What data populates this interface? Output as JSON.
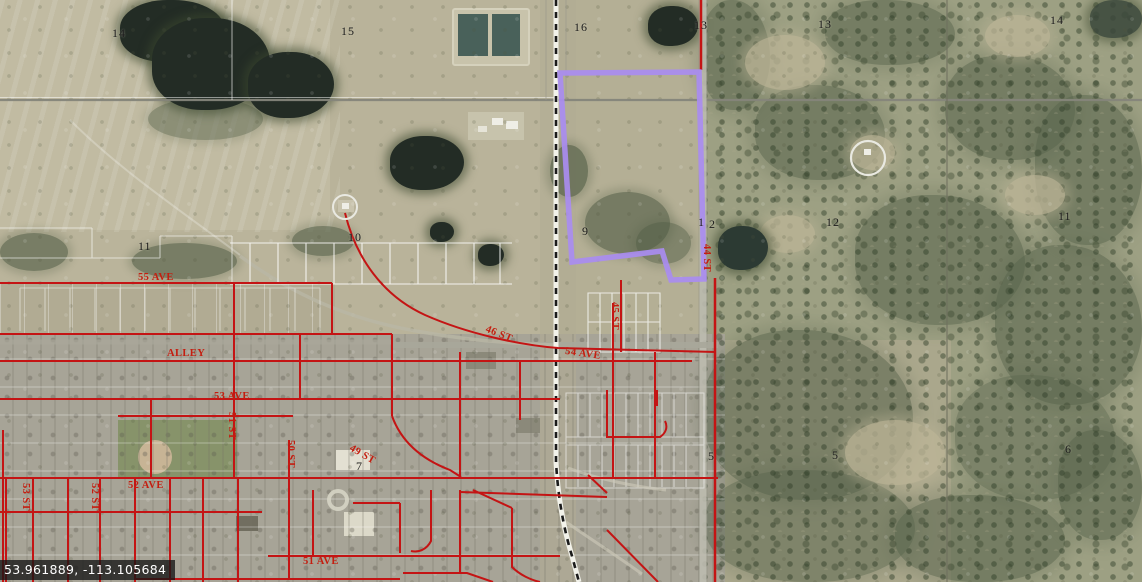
{
  "map_view": {
    "coordinate_readout": "53.961889, -113.105684",
    "colors": {
      "parcel_highlight": "#a98cf0",
      "road_overlay": "#c41414",
      "street_label": "#c41e10",
      "section_label": "#1c1c1c",
      "readout_bg": "rgba(22,22,22,0.78)",
      "readout_text": "#ffffff"
    },
    "section_labels": [
      {
        "text": "14",
        "x": 112,
        "y": 26
      },
      {
        "text": "15",
        "x": 341,
        "y": 24
      },
      {
        "text": "16",
        "x": 574,
        "y": 20
      },
      {
        "text": "13",
        "x": 694,
        "y": 18
      },
      {
        "text": "13",
        "x": 818,
        "y": 17
      },
      {
        "text": "14",
        "x": 1050,
        "y": 13
      },
      {
        "text": "11",
        "x": 138,
        "y": 239
      },
      {
        "text": "10",
        "x": 348,
        "y": 230
      },
      {
        "text": "9",
        "x": 582,
        "y": 224
      },
      {
        "text": "1",
        "x": 698,
        "y": 215
      },
      {
        "text": "2",
        "x": 709,
        "y": 217
      },
      {
        "text": "12",
        "x": 826,
        "y": 215
      },
      {
        "text": "11",
        "x": 1058,
        "y": 209
      },
      {
        "text": "7",
        "x": 356,
        "y": 459
      },
      {
        "text": "5",
        "x": 708,
        "y": 449
      },
      {
        "text": "5",
        "x": 832,
        "y": 448
      },
      {
        "text": "6",
        "x": 1065,
        "y": 442
      }
    ],
    "street_labels": [
      {
        "text": "55 AVE",
        "x": 138,
        "y": 272,
        "rotate": 0
      },
      {
        "text": "ALLEY",
        "x": 167,
        "y": 348,
        "rotate": 0
      },
      {
        "text": "53 AVE",
        "x": 214,
        "y": 391,
        "rotate": 0
      },
      {
        "text": "46 ST",
        "x": 488,
        "y": 324,
        "rotate": 22
      },
      {
        "text": "54 AVE",
        "x": 566,
        "y": 346,
        "rotate": 8
      },
      {
        "text": "45 ST",
        "x": 620,
        "y": 302,
        "rotate": 90
      },
      {
        "text": "44 ST",
        "x": 712,
        "y": 244,
        "rotate": 90
      },
      {
        "text": "51 ST",
        "x": 237,
        "y": 412,
        "rotate": 90
      },
      {
        "text": "50 ST",
        "x": 296,
        "y": 440,
        "rotate": 90
      },
      {
        "text": "49 ST",
        "x": 353,
        "y": 443,
        "rotate": 30
      },
      {
        "text": "52 AVE",
        "x": 128,
        "y": 480,
        "rotate": 0
      },
      {
        "text": "51 AVE",
        "x": 303,
        "y": 556,
        "rotate": 0
      },
      {
        "text": "53 ST",
        "x": 31,
        "y": 483,
        "rotate": 90
      },
      {
        "text": "52 ST",
        "x": 100,
        "y": 483,
        "rotate": 90
      }
    ]
  }
}
